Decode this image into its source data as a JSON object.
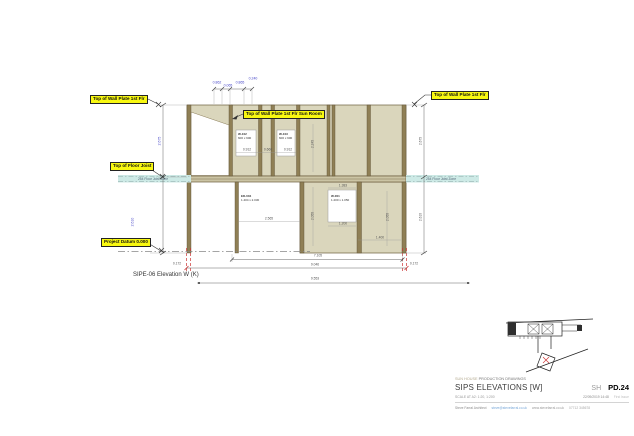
{
  "colors": {
    "panel": "#dad6bc",
    "stud": "#8f7f55",
    "panel_edge": "#6b5d3d",
    "joist_zone_teal": "#cdeae6",
    "sip_extent_red": "#cc3333",
    "dim_blue": "#4848c8",
    "callout_yellow": "#f8f811"
  },
  "drawing_title": "SIPE-06 Elevation W (K)",
  "zone_labels": {
    "left": "254 Floor Joist Zone",
    "right": "254 Floor Joist Zone"
  },
  "callouts": [
    {
      "text": "Top of Wall Plate 1st Flr",
      "x": 90,
      "y": 95
    },
    {
      "text": "Top of Wall Plate 1st Flr Sun Room",
      "x": 243,
      "y": 110
    },
    {
      "text": "Top of Wall Plate 1st Flr",
      "x": 431,
      "y": 91
    },
    {
      "text": "Top of Floor Joist",
      "x": 110,
      "y": 162
    },
    {
      "text": "Project Datum 0.000",
      "x": 101,
      "y": 238
    }
  ],
  "opening_labels": [
    {
      "id": "W-102",
      "size": "600 x 900",
      "x": 238,
      "y": 133
    },
    {
      "id": "W-103",
      "size": "600 x 900",
      "x": 279,
      "y": 133
    },
    {
      "id": "ED-004",
      "size": "1.404 x 2.030",
      "x": 241,
      "y": 195
    },
    {
      "id": "W-001",
      "size": "1.200 x 1.050",
      "x": 331,
      "y": 195
    }
  ],
  "annotations": [
    {
      "text": "0.862",
      "x": 217,
      "y": 83,
      "cls": "blue"
    },
    {
      "text": "0.065",
      "x": 228,
      "y": 86,
      "cls": "blue"
    },
    {
      "text": "0.865",
      "x": 240,
      "y": 83,
      "cls": "blue"
    },
    {
      "text": "0.240",
      "x": 253,
      "y": 79,
      "cls": "blue"
    },
    {
      "text": "2.675",
      "x": 160,
      "y": 141,
      "rot": -90,
      "cls": "blue"
    },
    {
      "text": "2.610",
      "x": 133,
      "y": 222,
      "rot": -90,
      "cls": "blue"
    },
    {
      "text": "2.675",
      "x": 421,
      "y": 141,
      "rot": -90
    },
    {
      "text": "2.610",
      "x": 421,
      "y": 217,
      "rot": -90
    },
    {
      "text": "0.912",
      "x": 247,
      "y": 150
    },
    {
      "text": "0.660",
      "x": 268,
      "y": 150
    },
    {
      "text": "0.912",
      "x": 288,
      "y": 150
    },
    {
      "text": "2.245",
      "x": 313,
      "y": 144,
      "rot": -90
    },
    {
      "text": "2.055",
      "x": 313,
      "y": 216,
      "rot": -90
    },
    {
      "text": "1.383",
      "x": 343,
      "y": 186
    },
    {
      "text": "1.200",
      "x": 343,
      "y": 224
    },
    {
      "text": "2.055",
      "x": 388,
      "y": 217,
      "rot": -90
    },
    {
      "text": "1.400",
      "x": 380,
      "y": 238
    },
    {
      "text": "2.565",
      "x": 269,
      "y": 219
    },
    {
      "text": "7.105",
      "x": 318,
      "y": 256
    },
    {
      "text": "0.172",
      "x": 177,
      "y": 264
    },
    {
      "text": "9.046",
      "x": 315,
      "y": 265
    },
    {
      "text": "0.172",
      "x": 414,
      "y": 264
    },
    {
      "text": "9.553",
      "x": 315,
      "y": 279
    }
  ],
  "title_block": {
    "project_line_light": "SUN HOUSE",
    "project_line_dark": "PRODUCTION DRAWINGS",
    "sheet_title": "SIPS ELEVATIONS [W]",
    "sheet_code": "SH",
    "sheet_number": "PD.24",
    "scale_line": "SCALE AT A2: 1:20, 1:200",
    "datetime": "22/09/2019 14:48",
    "revision": "First Issue",
    "architect": "Steve Farral Architect",
    "email": "steve@stevefarral.co.uk",
    "website": "www.stevefarral.co.uk",
    "phone": "07712 345678"
  }
}
